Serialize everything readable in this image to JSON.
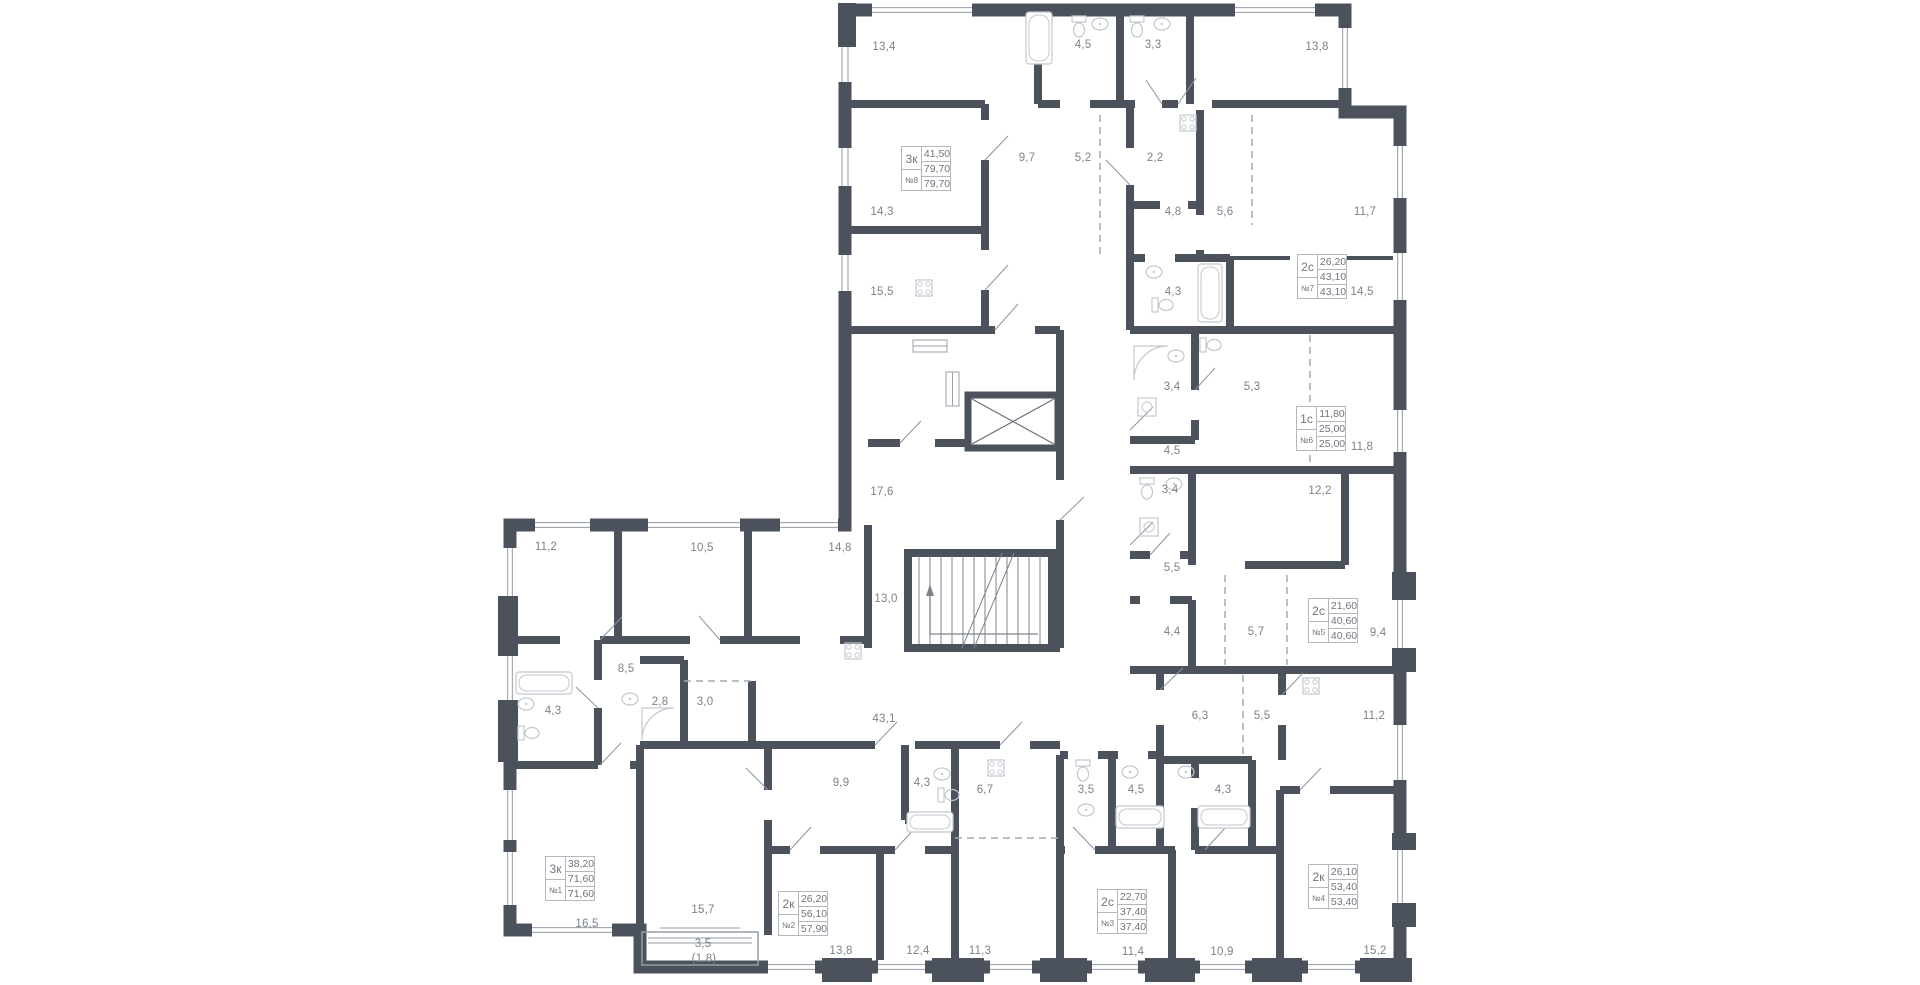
{
  "plan": {
    "wall_color": "#4b525c",
    "label_color": "#7c828a",
    "window_color": "#959ca6",
    "fixture_color": "#c3c8cf",
    "dashed_color": "#a4aab2",
    "box_border_color": "#b4b8be",
    "box_text_color": "#6f757d",
    "apartments": [
      {
        "number": "№8",
        "type": "3к",
        "living_area": "41,50",
        "area": "79,70",
        "total_area": "79,70",
        "box_x": 901,
        "box_y": 146
      },
      {
        "number": "№7",
        "type": "2с",
        "living_area": "26,20",
        "area": "43,10",
        "total_area": "43,10",
        "box_x": 1297,
        "box_y": 254
      },
      {
        "number": "№6",
        "type": "1с",
        "living_area": "11,80",
        "area": "25,00",
        "total_area": "25,00",
        "box_x": 1296,
        "box_y": 406
      },
      {
        "number": "№5",
        "type": "2с",
        "living_area": "21,60",
        "area": "40,60",
        "total_area": "40,60",
        "box_x": 1308,
        "box_y": 598
      },
      {
        "number": "№4",
        "type": "2к",
        "living_area": "26,10",
        "area": "53,40",
        "total_area": "53,40",
        "box_x": 1308,
        "box_y": 864
      },
      {
        "number": "№3",
        "type": "2с",
        "living_area": "22,70",
        "area": "37,40",
        "total_area": "37,40",
        "box_x": 1097,
        "box_y": 889
      },
      {
        "number": "№2",
        "type": "2к",
        "living_area": "26,20",
        "area": "56,10",
        "total_area": "57,90",
        "box_x": 778,
        "box_y": 891
      },
      {
        "number": "№1",
        "type": "3к",
        "living_area": "38,20",
        "area": "71,60",
        "total_area": "71,60",
        "box_x": 545,
        "box_y": 856
      }
    ],
    "room_labels": [
      {
        "area": "13,4",
        "x": 884,
        "y": 47,
        "apartment": "№8"
      },
      {
        "area": "4,5",
        "x": 1083,
        "y": 45,
        "apartment": "№8"
      },
      {
        "area": "3,3",
        "x": 1153,
        "y": 45,
        "apartment": "№8"
      },
      {
        "area": "13,8",
        "x": 1317,
        "y": 47,
        "apartment": "№8"
      },
      {
        "area": "9,7",
        "x": 1027,
        "y": 158,
        "apartment": "№8"
      },
      {
        "area": "5,2",
        "x": 1083,
        "y": 158,
        "apartment": "№8"
      },
      {
        "area": "2,2",
        "x": 1155,
        "y": 158,
        "apartment": "№7"
      },
      {
        "area": "14,3",
        "x": 882,
        "y": 212,
        "apartment": "№8"
      },
      {
        "area": "15,5",
        "x": 882,
        "y": 292,
        "apartment": "№8"
      },
      {
        "area": "4,8",
        "x": 1173,
        "y": 212,
        "apartment": "№7"
      },
      {
        "area": "5,6",
        "x": 1225,
        "y": 212,
        "apartment": "№7"
      },
      {
        "area": "11,7",
        "x": 1365,
        "y": 212,
        "apartment": "№7"
      },
      {
        "area": "4,3",
        "x": 1173,
        "y": 292,
        "apartment": "№7"
      },
      {
        "area": "14,5",
        "x": 1362,
        "y": 292,
        "apartment": "№7"
      },
      {
        "area": "3,4",
        "x": 1172,
        "y": 387,
        "apartment": "№6"
      },
      {
        "area": "5,3",
        "x": 1252,
        "y": 387,
        "apartment": "№6"
      },
      {
        "area": "4,5",
        "x": 1172,
        "y": 451,
        "apartment": "№6"
      },
      {
        "area": "11,8",
        "x": 1362,
        "y": 447,
        "apartment": "№6"
      },
      {
        "area": "17,6",
        "x": 882,
        "y": 492,
        "apartment": "common"
      },
      {
        "area": "3,4",
        "x": 1170,
        "y": 490,
        "apartment": "№5"
      },
      {
        "area": "12,2",
        "x": 1320,
        "y": 491,
        "apartment": "№5"
      },
      {
        "area": "5,5",
        "x": 1172,
        "y": 568,
        "apartment": "№5"
      },
      {
        "area": "13,0",
        "x": 886,
        "y": 599,
        "apartment": "common"
      },
      {
        "area": "4,4",
        "x": 1172,
        "y": 632,
        "apartment": "№5"
      },
      {
        "area": "5,7",
        "x": 1256,
        "y": 632,
        "apartment": "№5"
      },
      {
        "area": "9,4",
        "x": 1378,
        "y": 633,
        "apartment": "№5"
      },
      {
        "area": "6,3",
        "x": 1200,
        "y": 716,
        "apartment": "№4"
      },
      {
        "area": "5,5",
        "x": 1262,
        "y": 716,
        "apartment": "№4"
      },
      {
        "area": "11,2",
        "x": 1374,
        "y": 716,
        "apartment": "№4"
      },
      {
        "area": "43,1",
        "x": 884,
        "y": 719,
        "apartment": "common"
      },
      {
        "area": "11,2",
        "x": 546,
        "y": 547,
        "apartment": "№1"
      },
      {
        "area": "10,5",
        "x": 702,
        "y": 548,
        "apartment": "№1"
      },
      {
        "area": "14,8",
        "x": 840,
        "y": 548,
        "apartment": "№1"
      },
      {
        "area": "8,5",
        "x": 626,
        "y": 669,
        "apartment": "№1"
      },
      {
        "area": "2,8",
        "x": 660,
        "y": 702,
        "apartment": "№1"
      },
      {
        "area": "3,0",
        "x": 705,
        "y": 702,
        "apartment": "№1"
      },
      {
        "area": "4,3",
        "x": 553,
        "y": 711,
        "apartment": "№1"
      },
      {
        "area": "9,9",
        "x": 841,
        "y": 783,
        "apartment": "№2"
      },
      {
        "area": "4,3",
        "x": 922,
        "y": 783,
        "apartment": "№2"
      },
      {
        "area": "6,7",
        "x": 985,
        "y": 790,
        "apartment": "№3"
      },
      {
        "area": "3,5",
        "x": 1086,
        "y": 790,
        "apartment": "№3"
      },
      {
        "area": "4,5",
        "x": 1136,
        "y": 790,
        "apartment": "№3"
      },
      {
        "area": "4,3",
        "x": 1223,
        "y": 790,
        "apartment": "№4"
      },
      {
        "area": "16,5",
        "x": 587,
        "y": 924,
        "apartment": "№1"
      },
      {
        "area": "15,7",
        "x": 703,
        "y": 910,
        "apartment": "№2"
      },
      {
        "area": "3,5",
        "x": 703,
        "y": 944,
        "apartment": "№2"
      },
      {
        "area": "(1,8)",
        "x": 704,
        "y": 959,
        "apartment": "№2"
      },
      {
        "area": "13,8",
        "x": 841,
        "y": 951,
        "apartment": "№2"
      },
      {
        "area": "12,4",
        "x": 918,
        "y": 951,
        "apartment": "№2"
      },
      {
        "area": "11,3",
        "x": 980,
        "y": 951,
        "apartment": "№3"
      },
      {
        "area": "11,4",
        "x": 1133,
        "y": 952,
        "apartment": "№3"
      },
      {
        "area": "10,9",
        "x": 1222,
        "y": 952,
        "apartment": "№4"
      },
      {
        "area": "15,2",
        "x": 1375,
        "y": 951,
        "apartment": "№4"
      }
    ]
  }
}
